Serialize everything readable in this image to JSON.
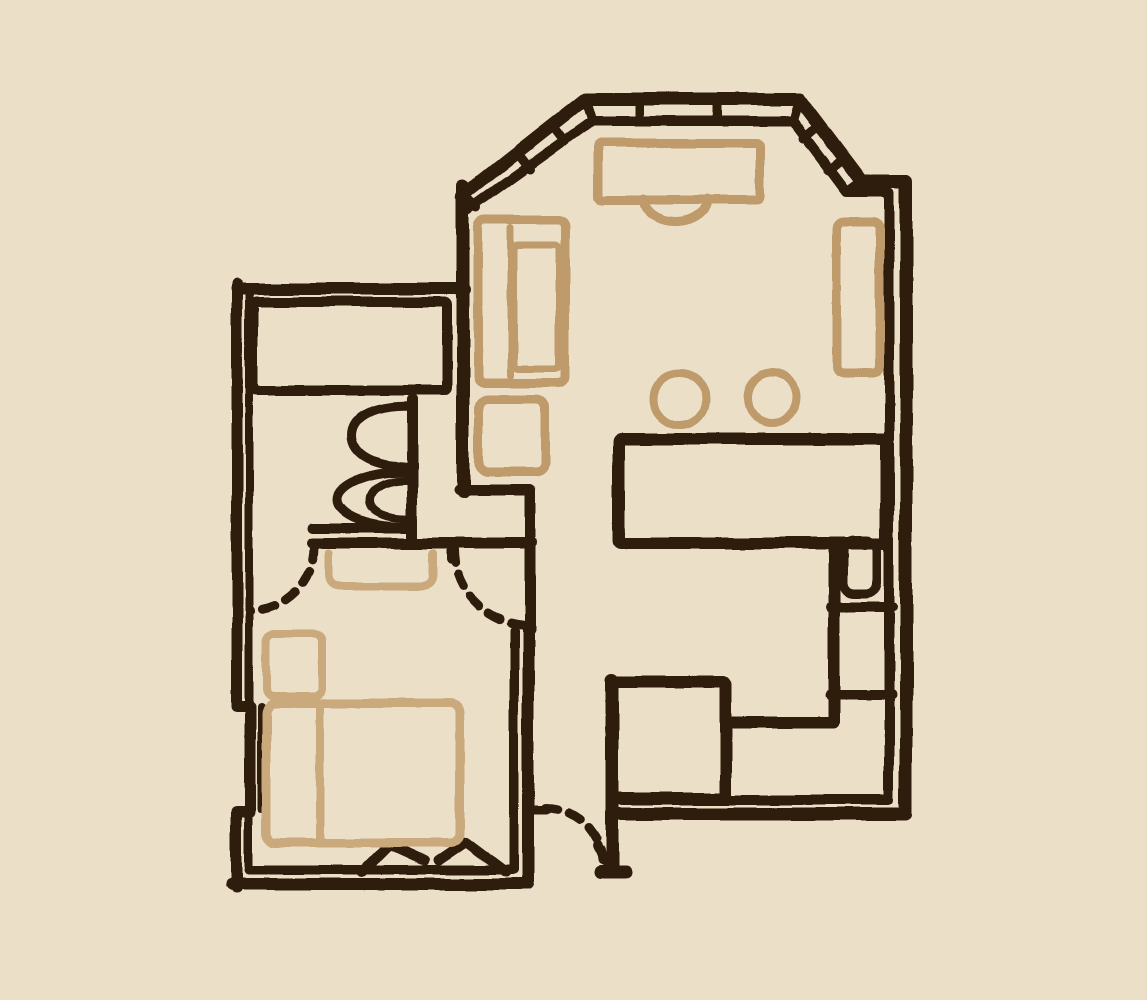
{
  "meta": {
    "title": "hand-drawn-apartment-floor-plan",
    "canvas_w": 1147,
    "canvas_h": 1000
  },
  "palette": {
    "background": "#ecdfc8",
    "wall": "#2f1e10",
    "furniture": "#bf9a6a",
    "furniture_light": "#caa97c"
  },
  "floorplan": {
    "shapes": [
      {
        "name": "outer-wall-bay-right-bottom",
        "type": "path",
        "stroke": "wall",
        "sw": 13,
        "d": "M 462 196 L 585 99 L 799 99 L 861 181 L 906 181 L 906 814 L 612 814"
      },
      {
        "name": "inner-wall-bay-right-bottom",
        "type": "path",
        "stroke": "wall",
        "sw": 10,
        "d": "M 468 210 L 592 121 L 793 121 L 846 192 L 889 192 L 889 800 L 620 800"
      },
      {
        "name": "bay-window-ticks",
        "type": "path",
        "stroke": "wall",
        "sw": 9,
        "d": "M 462 193 L 477 208 M 516 152 L 530 170 M 551 124 L 565 142 M 585 99 L 592 121 M 640 99 L 640 121 M 717 99 L 717 121 M 799 99 L 793 121 M 820 124 L 803 139 M 845 157 L 828 171 M 861 181 L 846 192 M 880 181 L 880 192"
      },
      {
        "name": "left-wing-top-wall",
        "type": "path",
        "stroke": "wall",
        "sw": 12,
        "d": "M 237 289 L 465 289"
      },
      {
        "name": "left-wall-outer",
        "type": "path",
        "stroke": "wall",
        "sw": 11,
        "d": "M 237 284 L 237 706 L 250 706 L 250 812 L 237 812 L 237 888"
      },
      {
        "name": "left-wall-inner",
        "type": "path",
        "stroke": "wall",
        "sw": 8,
        "d": "M 249 289 L 249 701 M 261 706 L 261 809 M 249 813 L 249 869"
      },
      {
        "name": "bedroom-outer-wall",
        "type": "path",
        "stroke": "wall",
        "sw": 12,
        "d": "M 233 884 L 528 884 L 528 628"
      },
      {
        "name": "bedroom-inner-wall",
        "type": "path",
        "stroke": "wall",
        "sw": 9,
        "d": "M 249 870 L 514 870 L 514 631"
      },
      {
        "name": "hallway-walls",
        "type": "path",
        "stroke": "wall",
        "sw": 11,
        "d": "M 459 490 L 530 490 L 530 630 M 312 543 L 532 543 M 452 543 L 452 559"
      },
      {
        "name": "living-room-left-wall",
        "type": "path",
        "stroke": "wall",
        "sw": 13,
        "d": "M 463 185 L 463 492"
      },
      {
        "name": "bathroom-closet",
        "type": "rect",
        "stroke": "wall",
        "sw": 10,
        "x": 253,
        "y": 302,
        "w": 194,
        "h": 88
      },
      {
        "name": "bathroom-right-wall",
        "type": "path",
        "stroke": "wall",
        "sw": 11,
        "d": "M 412 399 L 412 537"
      },
      {
        "name": "bathroom-bottom-wall",
        "type": "path",
        "stroke": "wall",
        "sw": 10,
        "d": "M 312 528 L 412 528"
      },
      {
        "name": "toilet",
        "type": "path",
        "stroke": "wall",
        "sw": 9,
        "d": "M 412 406 C 375 404 352 417 352 436 C 352 455 375 468 412 466"
      },
      {
        "name": "bidet",
        "type": "path",
        "stroke": "wall",
        "sw": 9,
        "d": "M 412 472 C 368 470 338 485 338 499 C 338 514 368 528 412 526"
      },
      {
        "name": "bidet-inner",
        "type": "path",
        "stroke": "wall",
        "sw": 8,
        "d": "M 412 480 C 386 479 370 488 370 500 C 370 511 386 519 412 518"
      },
      {
        "name": "kitchen-counter",
        "type": "rect",
        "stroke": "wall",
        "sw": 12,
        "x": 619,
        "y": 439,
        "w": 267,
        "h": 104
      },
      {
        "name": "kitchen-divider-wall",
        "type": "path",
        "stroke": "wall",
        "sw": 12,
        "d": "M 834 543 L 834 722 L 733 722"
      },
      {
        "name": "kitchen-sink",
        "type": "rect",
        "stroke": "wall",
        "sw": 9,
        "x": 843,
        "y": 540,
        "w": 34,
        "h": 54,
        "rx": 11
      },
      {
        "name": "kitchen-shelf-divider-1",
        "type": "path",
        "stroke": "wall",
        "sw": 10,
        "d": "M 830 607 L 892 607"
      },
      {
        "name": "kitchen-shelf-divider-2",
        "type": "path",
        "stroke": "wall",
        "sw": 10,
        "d": "M 830 695 L 892 695"
      },
      {
        "name": "utility-shaft",
        "type": "rect",
        "stroke": "wall",
        "sw": 12,
        "x": 612,
        "y": 682,
        "w": 114,
        "h": 116
      },
      {
        "name": "entry-wall",
        "type": "path",
        "stroke": "wall",
        "sw": 13,
        "d": "M 612 680 L 612 868 M 600 872 L 626 872"
      },
      {
        "name": "bed-foot-marks",
        "type": "path",
        "stroke": "wall",
        "sw": 10,
        "d": "M 362 872 L 389 845 L 424 861 M 438 861 L 466 842 L 506 872"
      },
      {
        "name": "bedroom-door-arc-left",
        "type": "path",
        "stroke": "wall",
        "sw": 9,
        "dash": "13 12",
        "d": "M 314 547 A 64 64 0 0 1 250 611"
      },
      {
        "name": "bedroom-door-arc-right",
        "type": "path",
        "stroke": "wall",
        "sw": 9,
        "dash": "13 12",
        "d": "M 454 550 A 76 76 0 0 0 530 626"
      },
      {
        "name": "entry-door-arc",
        "type": "path",
        "stroke": "wall",
        "sw": 9,
        "dash": "13 12",
        "d": "M 545 808 A 57 57 0 0 1 602 860"
      },
      {
        "name": "entry-door-hinge-marks",
        "type": "path",
        "stroke": "wall",
        "sw": 9,
        "d": "M 533 810 L 546 810 M 597 846 L 604 861"
      },
      {
        "name": "desk",
        "type": "rect",
        "stroke": "furniture",
        "sw": 9,
        "x": 598,
        "y": 143,
        "w": 162,
        "h": 57
      },
      {
        "name": "desk-chair",
        "type": "path",
        "stroke": "furniture",
        "sw": 9,
        "d": "M 643 199 A 32 23 0 0 0 707 199"
      },
      {
        "name": "sofa",
        "type": "rect",
        "stroke": "furniture",
        "sw": 9,
        "x": 478,
        "y": 220,
        "w": 87,
        "h": 163,
        "rx": 7
      },
      {
        "name": "sofa-back-line",
        "type": "path",
        "stroke": "furniture",
        "sw": 7,
        "d": "M 511 228 L 511 376"
      },
      {
        "name": "sofa-cushion",
        "type": "rect",
        "stroke": "furniture",
        "sw": 7,
        "x": 514,
        "y": 245,
        "w": 45,
        "h": 124,
        "rx": 5
      },
      {
        "name": "side-table",
        "type": "rect",
        "stroke": "furniture",
        "sw": 9,
        "x": 479,
        "y": 399,
        "w": 66,
        "h": 73,
        "rx": 9
      },
      {
        "name": "sideboard",
        "type": "rect",
        "stroke": "furniture",
        "sw": 9,
        "x": 837,
        "y": 222,
        "w": 43,
        "h": 151,
        "rx": 7
      },
      {
        "name": "stool-1",
        "type": "circle",
        "stroke": "furniture",
        "sw": 8,
        "cx": 680,
        "cy": 399,
        "r": 26
      },
      {
        "name": "stool-2",
        "type": "circle",
        "stroke": "furniture",
        "sw": 8,
        "cx": 772,
        "cy": 398,
        "r": 25
      },
      {
        "name": "door-mat",
        "type": "path",
        "stroke": "furniture_light",
        "sw": 8,
        "d": "M 329 553 L 329 574 Q 329 586 341 586 L 421 586 Q 433 586 433 574 L 433 553"
      },
      {
        "name": "nightstand",
        "type": "rect",
        "stroke": "furniture_light",
        "sw": 8,
        "x": 266,
        "y": 634,
        "w": 56,
        "h": 62,
        "rx": 8
      },
      {
        "name": "bed",
        "type": "rect",
        "stroke": "furniture_light",
        "sw": 9,
        "x": 266,
        "y": 703,
        "w": 194,
        "h": 140,
        "rx": 10
      },
      {
        "name": "bed-pillow-line",
        "type": "path",
        "stroke": "furniture_light",
        "sw": 8,
        "d": "M 320 708 L 320 838"
      }
    ]
  }
}
